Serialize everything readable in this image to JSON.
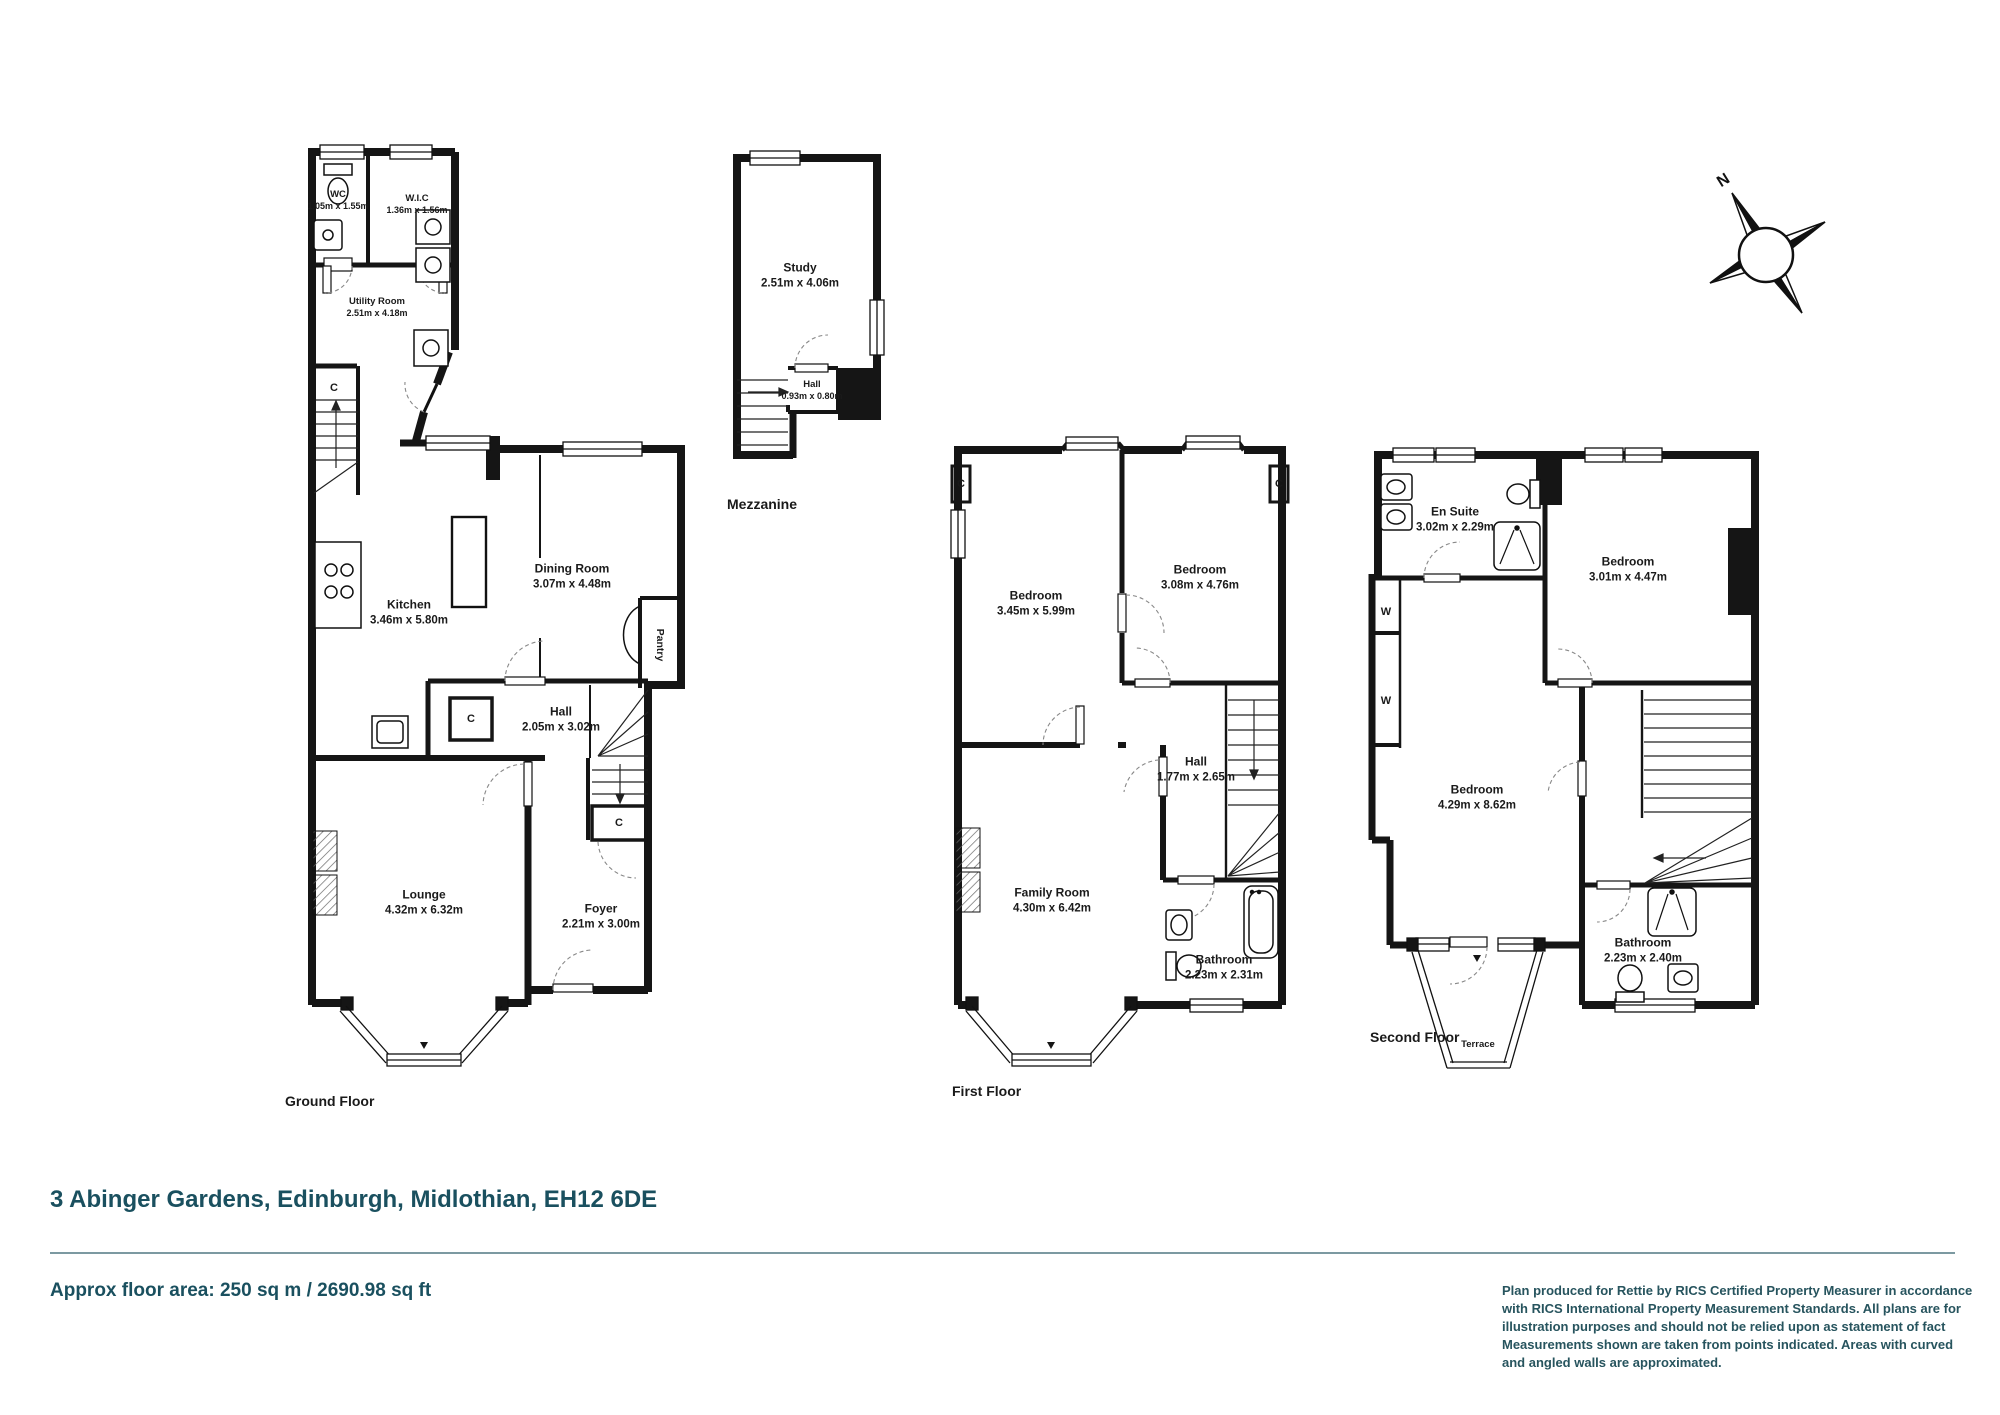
{
  "property": {
    "address": "3 Abinger Gardens, Edinburgh, Midlothian, EH12 6DE",
    "floor_area": "Approx floor area: 250 sq m / 2690.98 sq ft"
  },
  "disclaimer": "Plan produced for Rettie by RICS Certified Property Measurer in accordance with RICS International Property  Measurement Standards.  All plans are for illustration purposes and should not be relied upon as statement of fact Measurements shown are taken from points indicated. Areas with curved and angled walls are approximated.",
  "compass": {
    "north_label": "N"
  },
  "floors": {
    "ground": {
      "label": "Ground Floor",
      "cupboard_label": "C",
      "rooms": {
        "wc": {
          "name": "WC",
          "dims": "1.05m x 1.55m"
        },
        "wic": {
          "name": "W.I.C",
          "dims": "1.36m x 1.56m"
        },
        "utility": {
          "name": "Utility Room",
          "dims": "2.51m x 4.18m"
        },
        "kitchen": {
          "name": "Kitchen",
          "dims": "3.46m x 5.80m"
        },
        "dining": {
          "name": "Dining Room",
          "dims": "3.07m x 4.48m"
        },
        "pantry": {
          "name": "Pantry"
        },
        "hall": {
          "name": "Hall",
          "dims": "2.05m x 3.02m"
        },
        "lounge": {
          "name": "Lounge",
          "dims": "4.32m x 6.32m"
        },
        "foyer": {
          "name": "Foyer",
          "dims": "2.21m x 3.00m"
        }
      }
    },
    "mezzanine": {
      "label": "Mezzanine",
      "rooms": {
        "study": {
          "name": "Study",
          "dims": "2.51m x 4.06m"
        },
        "hall": {
          "name": "Hall",
          "dims": "0.93m x 0.80m"
        }
      }
    },
    "first": {
      "label": "First Floor",
      "cupboard_label": "C",
      "rooms": {
        "bedroom1": {
          "name": "Bedroom",
          "dims": "3.45m x 5.99m"
        },
        "bedroom2": {
          "name": "Bedroom",
          "dims": "3.08m x 4.76m"
        },
        "hall": {
          "name": "Hall",
          "dims": "1.77m x 2.65m"
        },
        "family": {
          "name": "Family Room",
          "dims": "4.30m x 6.42m"
        },
        "bathroom": {
          "name": "Bathroom",
          "dims": "2.23m x 2.31m"
        }
      }
    },
    "second": {
      "label": "Second Floor",
      "wardrobe_label": "W",
      "rooms": {
        "ensuite": {
          "name": "En Suite",
          "dims": "3.02m x 2.29m"
        },
        "bedroom3": {
          "name": "Bedroom",
          "dims": "3.01m x 4.47m"
        },
        "bedroom4": {
          "name": "Bedroom",
          "dims": "4.29m x 8.62m"
        },
        "bathroom": {
          "name": "Bathroom",
          "dims": "2.23m x 2.40m"
        },
        "terrace": {
          "name": "Terrace"
        }
      }
    }
  },
  "colors": {
    "accent": "#1a505f",
    "line": "#1a1a1a"
  }
}
